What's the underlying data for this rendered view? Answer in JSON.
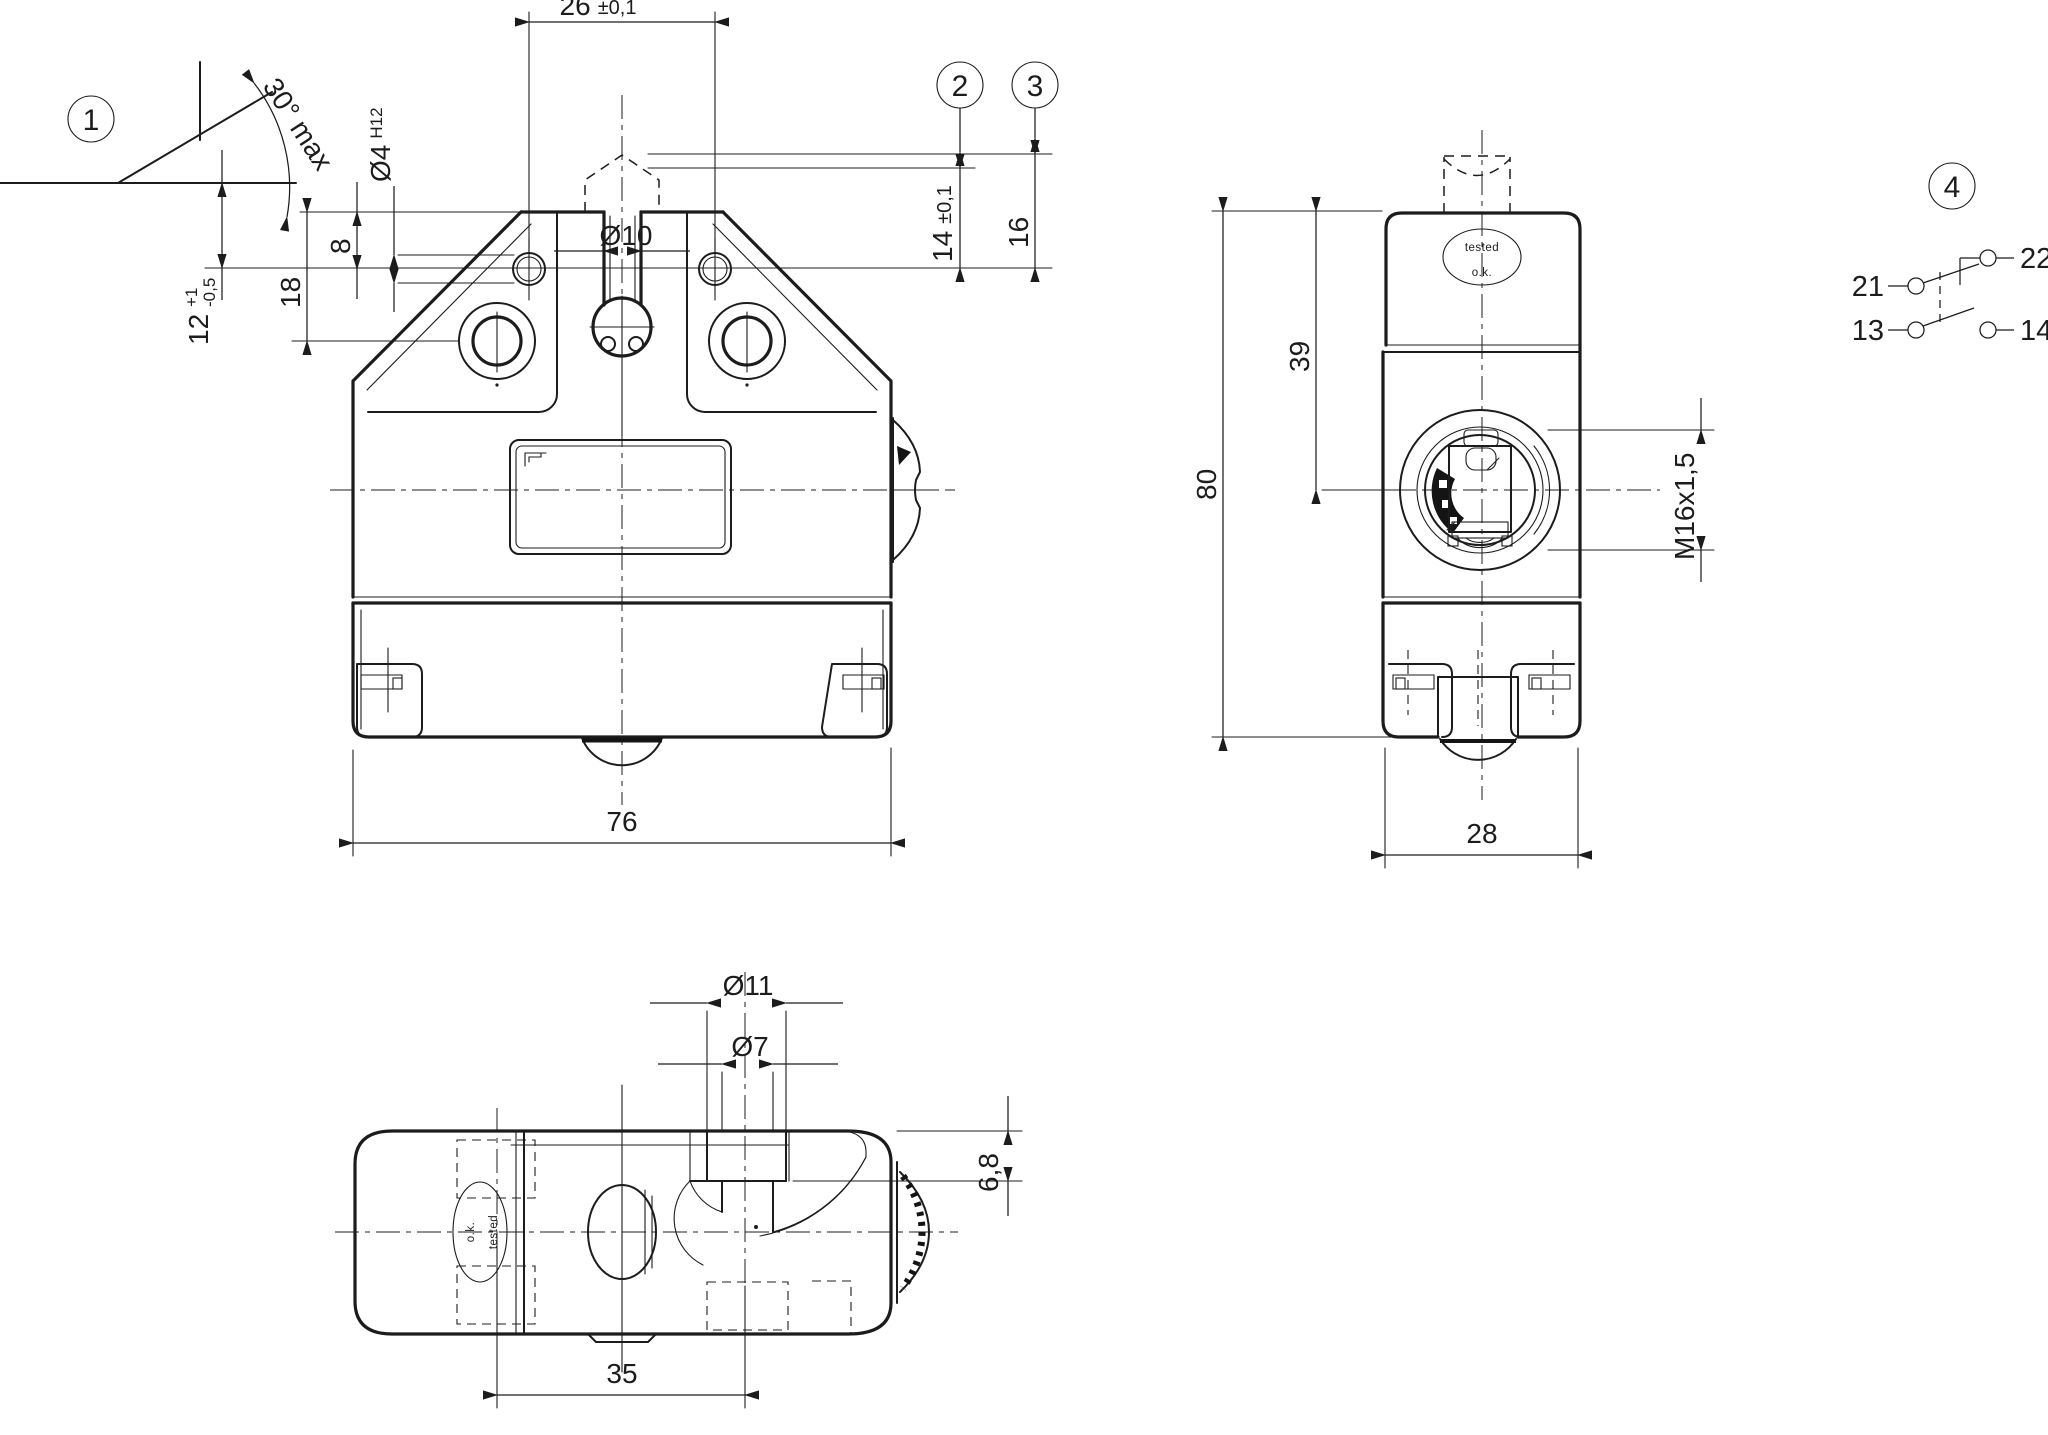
{
  "drawing": {
    "callouts": {
      "c1": "1",
      "c2": "2",
      "c3": "3",
      "c4": "4"
    },
    "detail1": {
      "angle": "30° max"
    },
    "front": {
      "d26": "26",
      "d26_tol": "±0,1",
      "d4": "Ø4",
      "d4_fit": "H12",
      "d10": "Ø10",
      "d8": "8",
      "d18": "18",
      "d12": "12",
      "d12_plus": "+1",
      "d12_minus": "-0,5",
      "d14": "14",
      "d14_tol": "±0,1",
      "d16": "16",
      "d76": "76"
    },
    "side": {
      "d39": "39",
      "d80": "80",
      "thread": "M16x1,5",
      "d28": "28"
    },
    "bottom": {
      "d11": "Ø11",
      "d7": "Ø7",
      "d68": "6,8",
      "d35": "35"
    },
    "stamps": {
      "tested": "tested",
      "ok": "o.k."
    },
    "circuit": {
      "t21": "21",
      "t22": "22",
      "t13": "13",
      "t14": "14"
    }
  }
}
